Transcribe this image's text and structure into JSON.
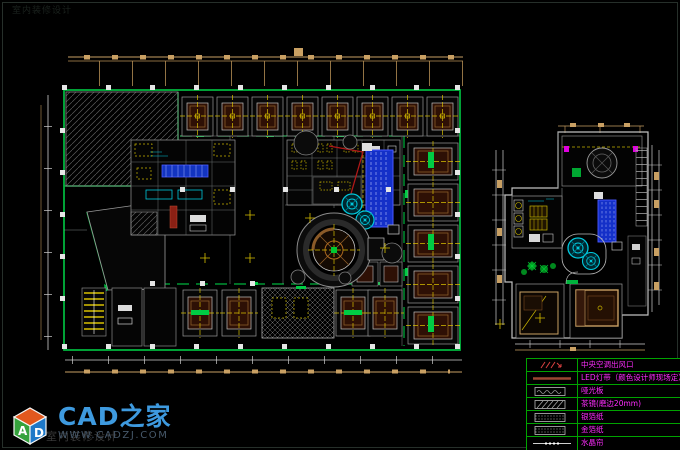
{
  "branding": {
    "logo_text": "CAD之家",
    "logo_url": "WWW.CADZJ.COM",
    "cube_letter_a": "A",
    "cube_letter_d": "D",
    "watermark_text": "室内装修设计"
  },
  "legend": {
    "rows": [
      {
        "symbol": "ac-vent",
        "label": "中央空调出风口"
      },
      {
        "symbol": "led-strip",
        "label": "LED灯带（颜色设计师现场定）"
      },
      {
        "symbol": "matte-panel",
        "label": "哑光板"
      },
      {
        "symbol": "tea-mirror",
        "label": "茶镜(磨边20mm)"
      },
      {
        "symbol": "silver-foil",
        "label": "银箔纸"
      },
      {
        "symbol": "gold-foil",
        "label": "金箔纸"
      },
      {
        "symbol": "crystal-curtain",
        "label": "水晶帘"
      }
    ]
  },
  "drawing": {
    "colors": {
      "wall_green": "#00b33c",
      "dimension_tan": "#c9a063",
      "centerline_yellow": "#d8c000",
      "equipment_blue": "#1430c8",
      "detail_cyan": "#00c8dc",
      "ceiling_brown": "#8a5a28",
      "section_red": "#b01818",
      "legend_magenta": "#ff2dff"
    }
  }
}
